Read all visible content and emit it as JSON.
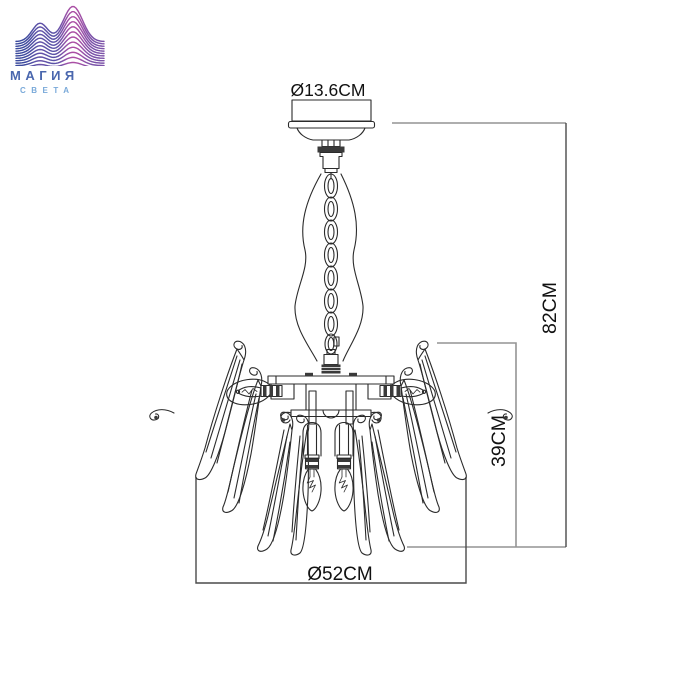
{
  "brand": {
    "title": "МАГИЯ",
    "subtitle": "СВЕТА"
  },
  "colors": {
    "brand_title": "#4a67ae",
    "brand_subtitle": "#79a9d9",
    "wave_gradient": [
      "#3b4a9d",
      "#5e52a8",
      "#9a51a8",
      "#c4499e"
    ],
    "drawing": "#2b2b2b",
    "dimension_primary": "#4a4a4a",
    "dimension_secondary": "#949494",
    "text": "#111111"
  },
  "dimensions": {
    "canopy_diameter": "Ø13.6CM",
    "overall_height": "82CM",
    "body_height": "39CM",
    "body_diameter": "Ø52CM"
  }
}
